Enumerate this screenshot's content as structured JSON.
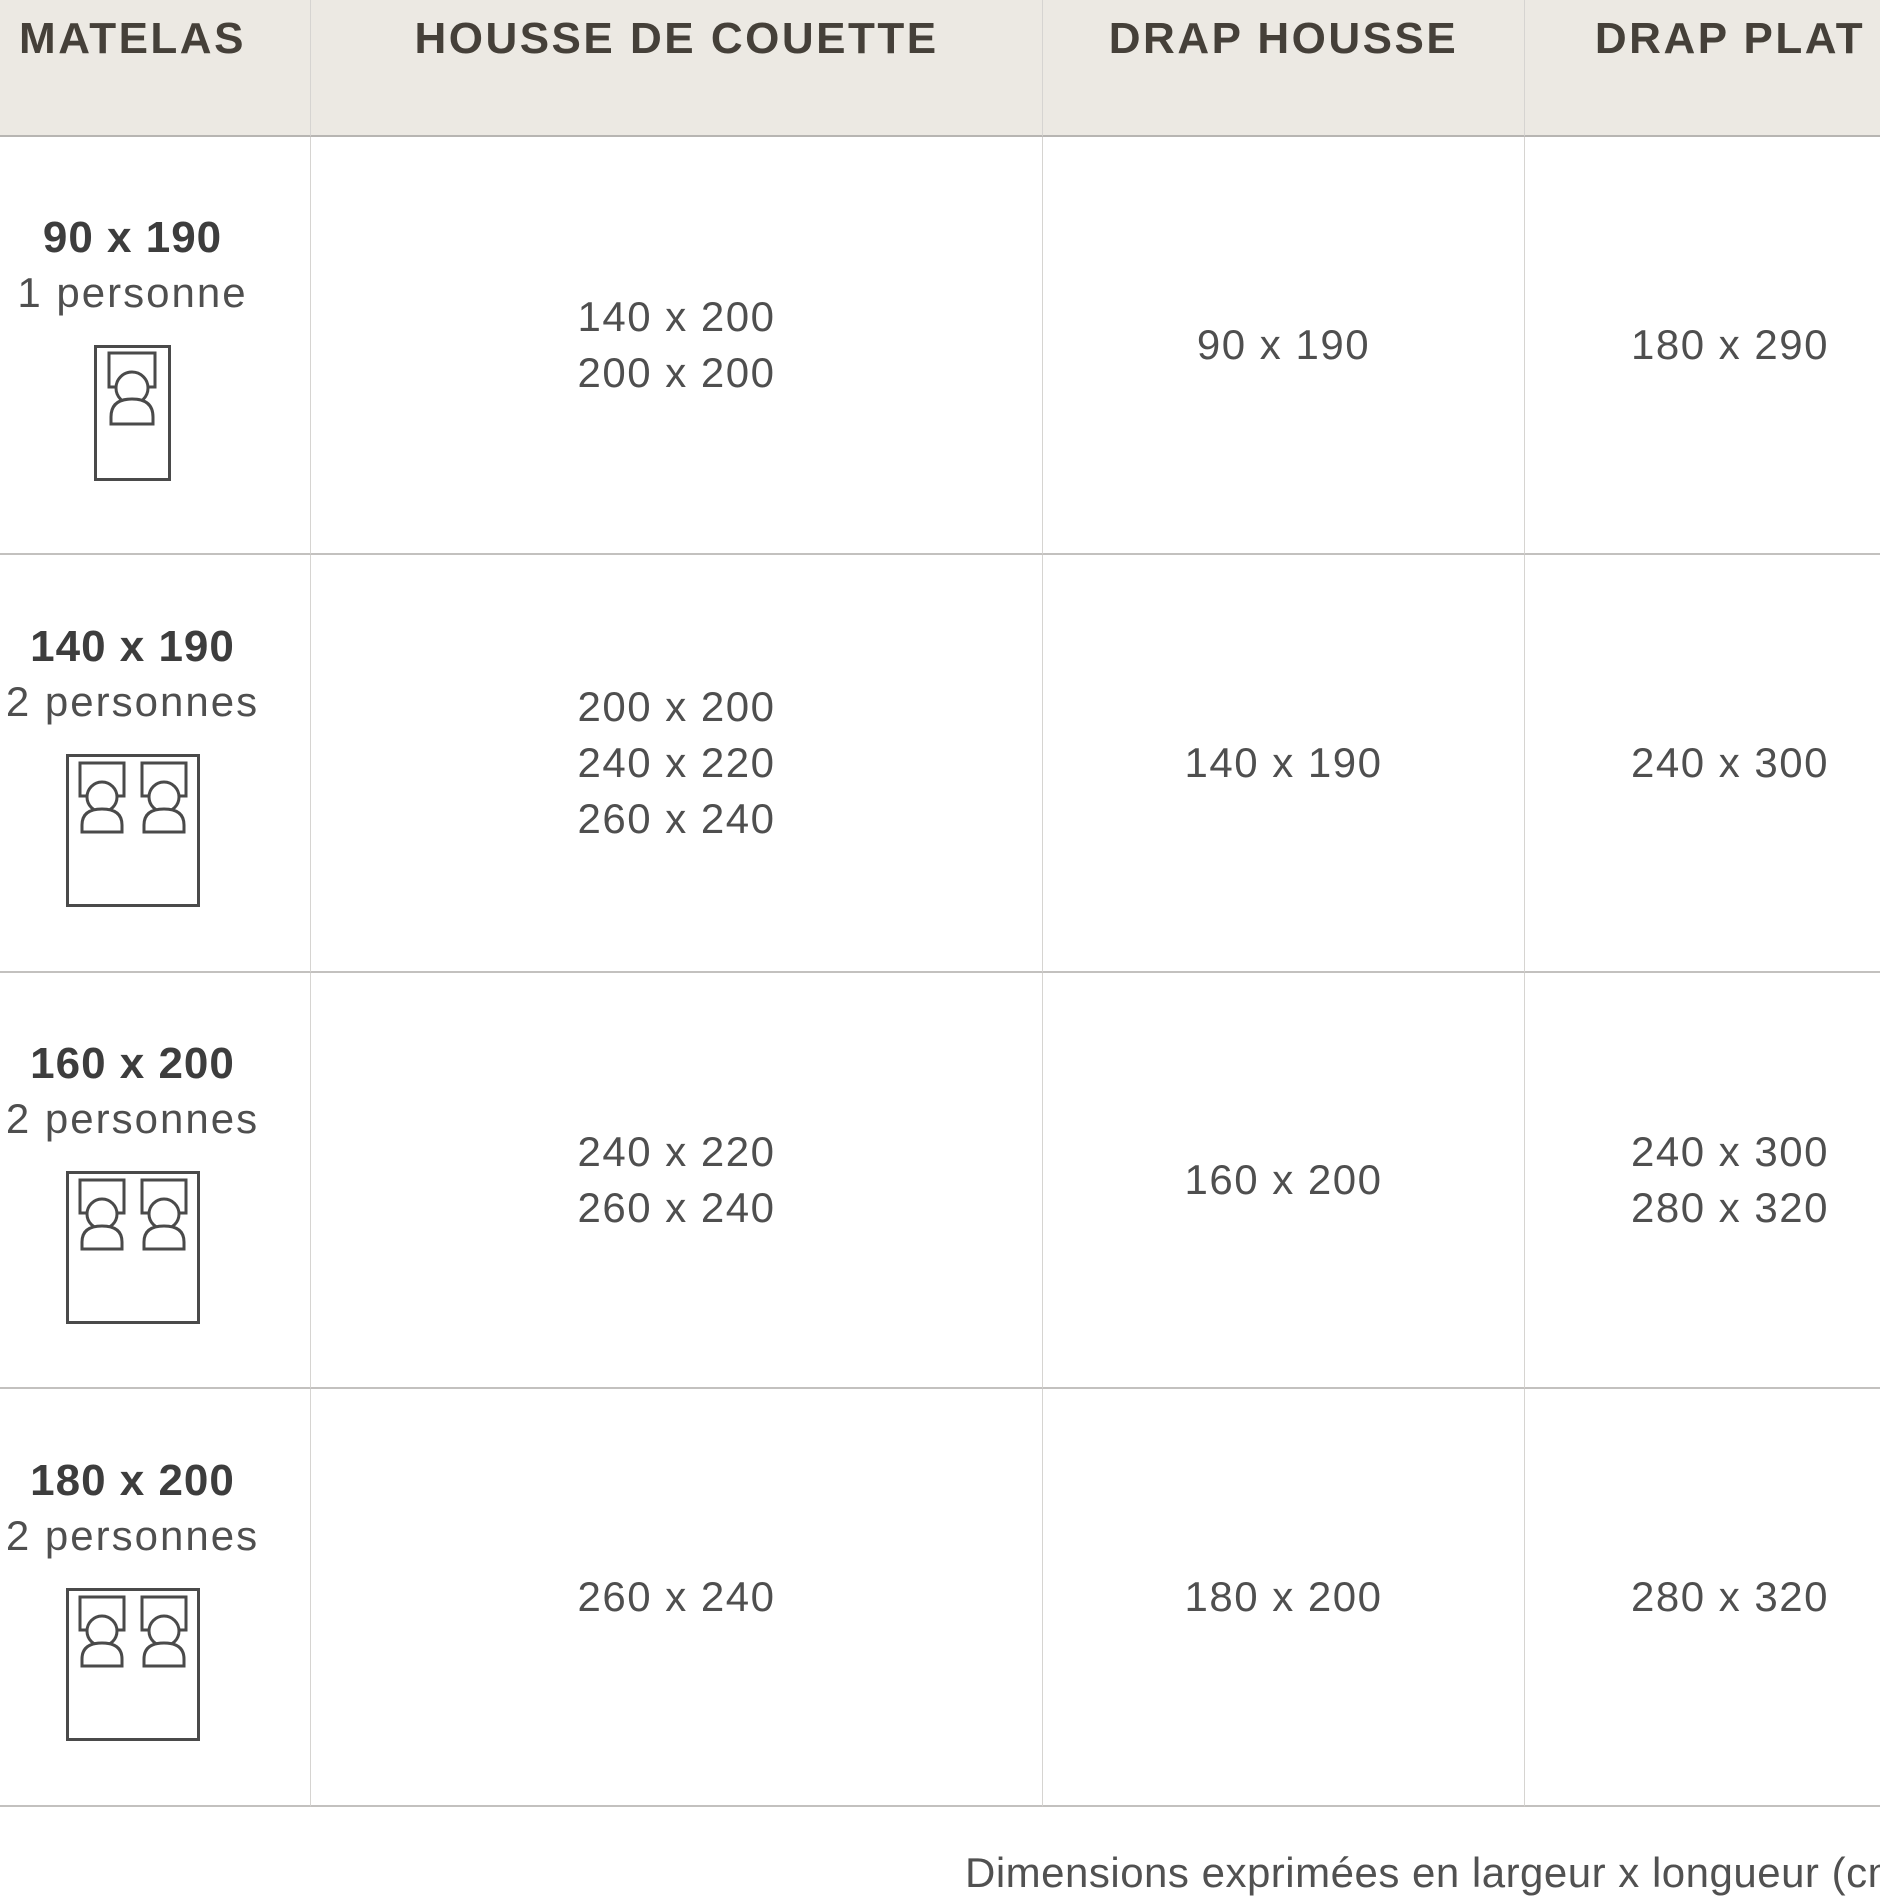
{
  "table": {
    "columns": [
      {
        "label": "MATELAS"
      },
      {
        "label": "HOUSSE DE COUETTE"
      },
      {
        "label": "DRAP HOUSSE"
      },
      {
        "label": "DRAP PLAT"
      }
    ],
    "rows": [
      {
        "size": "90 x 190",
        "persons": "1 personne",
        "bed": "single",
        "housse": [
          "140 x 200",
          "200 x 200"
        ],
        "drap_housse": [
          "90 x 190"
        ],
        "drap_plat": [
          "180 x 290"
        ]
      },
      {
        "size": "140 x 190",
        "persons": "2 personnes",
        "bed": "double",
        "housse": [
          "200 x 200",
          "240 x 220",
          "260 x 240"
        ],
        "drap_housse": [
          "140 x 190"
        ],
        "drap_plat": [
          "240 x 300"
        ]
      },
      {
        "size": "160 x 200",
        "persons": "2 personnes",
        "bed": "double",
        "housse": [
          "240 x 220",
          "260 x 240"
        ],
        "drap_housse": [
          "160 x 200"
        ],
        "drap_plat": [
          "240 x 300",
          "280 x 320"
        ]
      },
      {
        "size": "180 x 200",
        "persons": "2 personnes",
        "bed": "double",
        "housse": [
          "260 x 240"
        ],
        "drap_housse": [
          "180 x 200"
        ],
        "drap_plat": [
          "280 x 320"
        ]
      }
    ]
  },
  "footer": {
    "note": "Dimensions exprimées en largeur x longueur (cm)"
  },
  "colors": {
    "header_background": "#ece9e3",
    "header_text": "#454039",
    "body_text": "#4f4f4f",
    "bold_text": "#3d3d3d",
    "row_border": "#c3c1bf",
    "column_border": "#d6d4d1",
    "icon_stroke": "#4a4a4a"
  }
}
